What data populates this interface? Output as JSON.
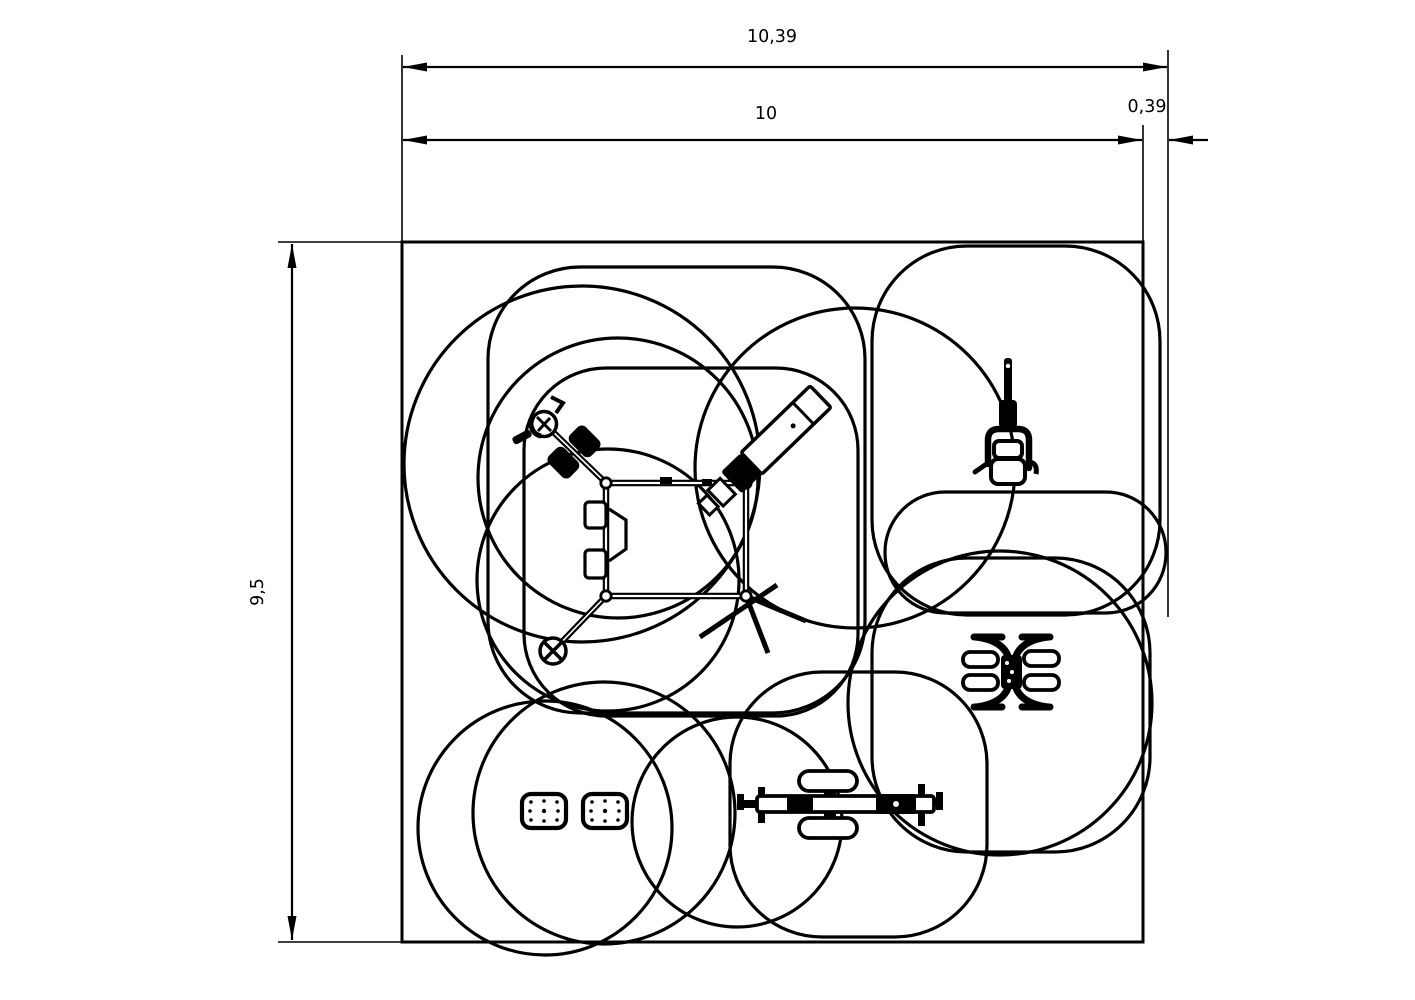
{
  "drawing": {
    "type": "equipment-safety-zone-plan",
    "dimensions": {
      "overall_width": "10,39",
      "main_width": "10",
      "side_extension": "0,39",
      "height": "9,5"
    },
    "colors": {
      "line": "#000000",
      "background": "#ffffff"
    },
    "icons": [
      "spinner-wheel-icon",
      "twin-pedal-icon",
      "incline-bench-icon",
      "overhead-press-station-icon",
      "four-seat-pendulum-icon",
      "tandem-exercise-bike-icon",
      "balance-plate-icon",
      "safety-zone-outline"
    ]
  }
}
